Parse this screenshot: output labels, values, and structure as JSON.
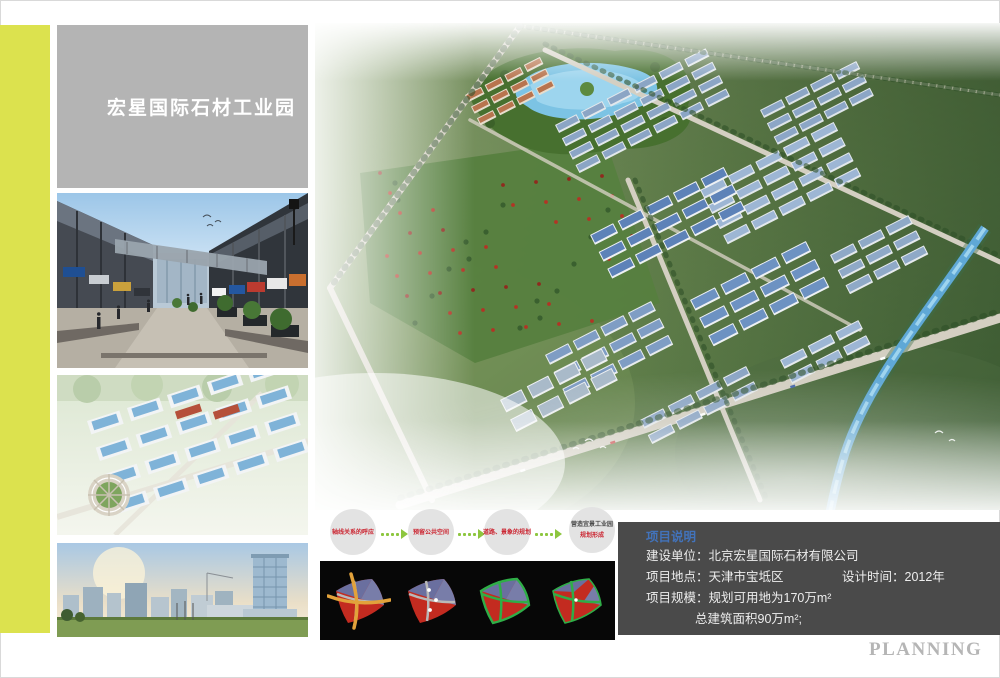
{
  "header": {
    "title": "宏星国际石材工业园"
  },
  "flow": {
    "steps": [
      {
        "label": "轴线关系的呼应"
      },
      {
        "label": "预留公共空间"
      },
      {
        "label": "道路、景象的规划"
      },
      {
        "label": "营造宜景工业园",
        "sub": "规划形成"
      }
    ]
  },
  "project_info": {
    "title": "项目说明",
    "line_builder": "建设单位：北京宏星国际石材有限公司",
    "line_location": "项目地点：天津市宝坻区",
    "line_design_time": "设计时间：2012年",
    "line_scale": "项目规模：规划可用地为170万m²",
    "line_area": "总建筑面积90万m²;"
  },
  "footer": {
    "planning_label": "PLANNING"
  },
  "colors": {
    "accent_stripe": "#dce24e",
    "title_box_gray": "#b4b4b4",
    "info_box_gray": "#4a4a4a",
    "info_title_blue": "#4273bb",
    "flow_text_red": "#cb2430",
    "arrow_green": "#8dc63f",
    "planning_gray": "#b5b5b5"
  }
}
